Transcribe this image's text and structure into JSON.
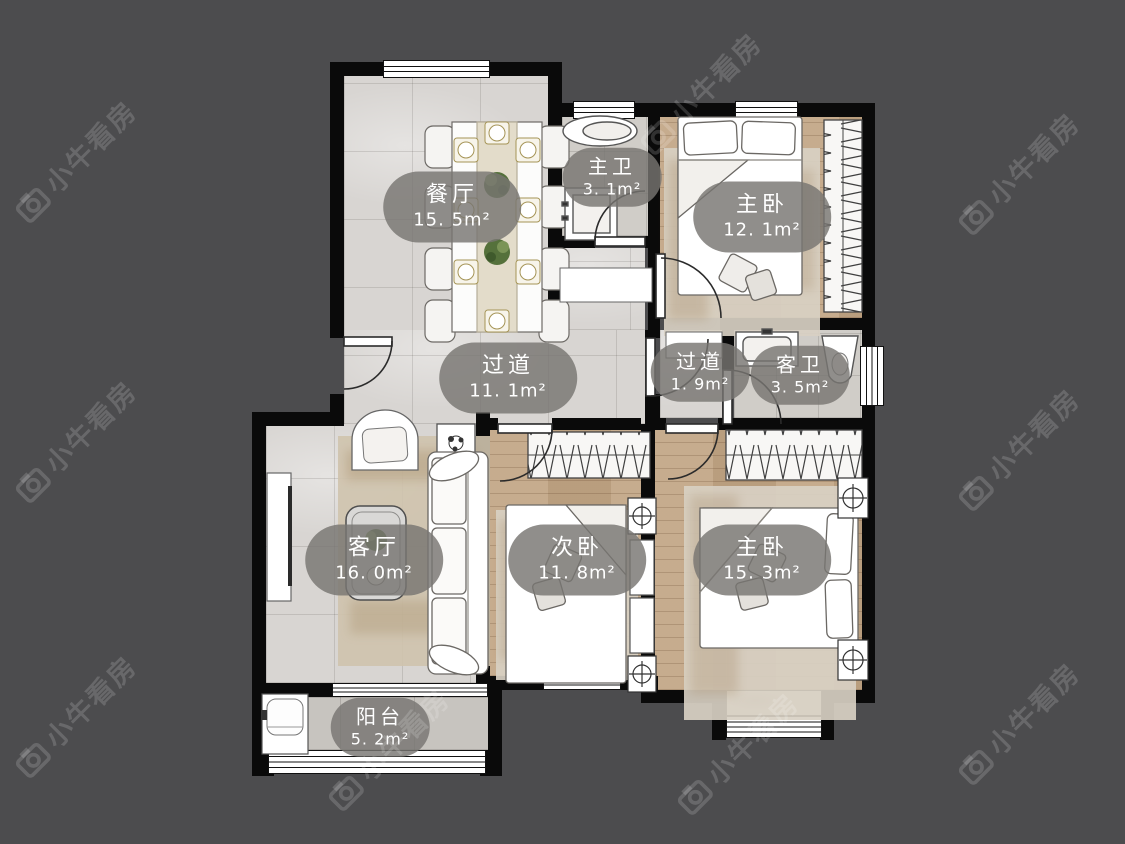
{
  "watermark": {
    "text": "小牛看房"
  },
  "rooms": {
    "dining": {
      "label": "餐厅",
      "area": "15. 5m²"
    },
    "master_bath": {
      "label": "主卫",
      "area": "3. 1m²"
    },
    "master_bedroom_top": {
      "label": "主卧",
      "area": "12. 1m²"
    },
    "hallway": {
      "label": "过道",
      "area": "11. 1m²"
    },
    "hallway_small": {
      "label": "过道",
      "area": "1. 9m²"
    },
    "guest_bath": {
      "label": "客卫",
      "area": "3. 5m²"
    },
    "living": {
      "label": "客厅",
      "area": "16. 0m²"
    },
    "second_bedroom": {
      "label": "次卧",
      "area": "11. 8m²"
    },
    "master_bedroom_bottom": {
      "label": "主卧",
      "area": "15. 3m²"
    },
    "balcony": {
      "label": "阳台",
      "area": "5. 2m²"
    }
  },
  "colors": {
    "background": "#4c4c4e",
    "wall": "#0a0a0a",
    "tile_floor": "#d8d5d2",
    "wood_floor": "#c3a787",
    "bath_floor": "#d0cdc8",
    "balcony_floor": "#c7c4bf",
    "label_bg": "rgba(120,117,113,0.82)",
    "label_text": "#ffffff",
    "watermark_color": "rgba(255,255,255,0.16)"
  }
}
